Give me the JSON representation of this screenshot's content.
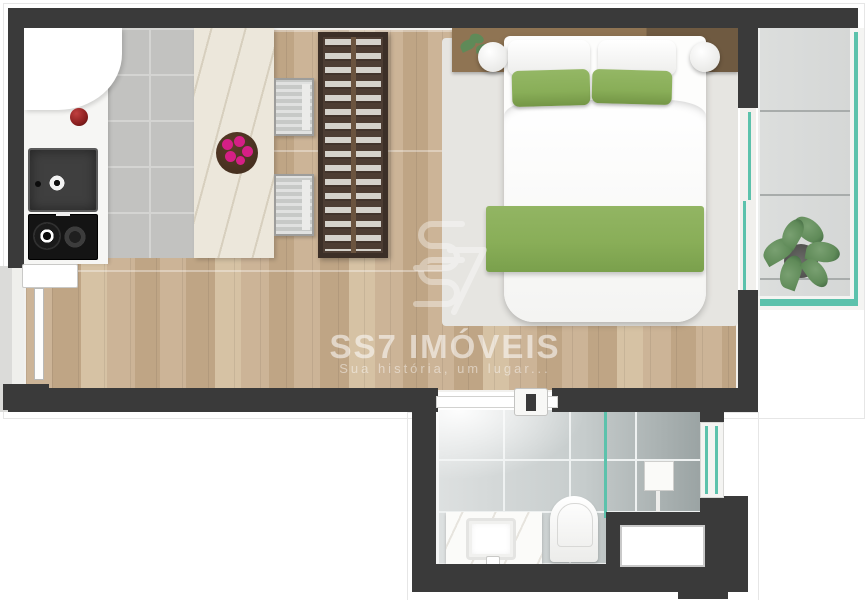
{
  "watermark": {
    "brand": "SS7 IMÓVEIS",
    "tagline": "Sua história, um lugar...",
    "logo": "ss7-monogram"
  },
  "palette": {
    "wall": "#3a3a3a",
    "wood_a": "#ccb497",
    "wood_b": "#bfa585",
    "wood_c": "#d6c2a4",
    "tile_kitchen": "#c2c2c0",
    "tile_joint": "#d4d4d2",
    "counter": "#f6f6f4",
    "marble": "#ece7db",
    "island_bowl": "#46301f",
    "accent_pink": "#d61f86",
    "fruit_red": "#8a1f1f",
    "appliance": "#3f3f3f",
    "rack_frame": "#3c2f27",
    "rack_bg": "#4d3d33",
    "clothes": "#d5d2cb",
    "rug": "#e6e5e1",
    "headboard_a": "#8f7453",
    "headboard_b": "#6f5a41",
    "bed_green": "#89ae58",
    "balcony_tile": "#d5d7d6",
    "balcony_joint": "#a8acab",
    "glass_teal": "#5cc2ac",
    "bath_tile_light": "#dde0e0",
    "bath_tile_dark": "#9aa3a3",
    "bath_grid": "#eef1f1",
    "plant_green": "#5f8a58",
    "plant_dark": "#3f6340",
    "shaft_white": "#ffffff",
    "watermark_white": "#ffffff"
  },
  "plan": {
    "type": "studio-apartment-floor-plan",
    "rooms": [
      "kitchen",
      "living-bedroom",
      "balcony",
      "bathroom"
    ],
    "fixtures": [
      "refrigerator",
      "kitchen-sink",
      "cooktop",
      "kitchen-island",
      "fruit-bowl",
      "bar-stool",
      "bar-stool",
      "open-wardrobe-rack",
      "double-bed",
      "bedside-lamp",
      "bedside-lamp",
      "headboard-plant",
      "entrance-door",
      "sliding-glass-door",
      "balcony-plant",
      "glass-railing",
      "bathroom-sliding-door",
      "vanity-sink",
      "toilet",
      "shower",
      "shower-glass-partition",
      "bathroom-window",
      "service-shaft"
    ]
  }
}
